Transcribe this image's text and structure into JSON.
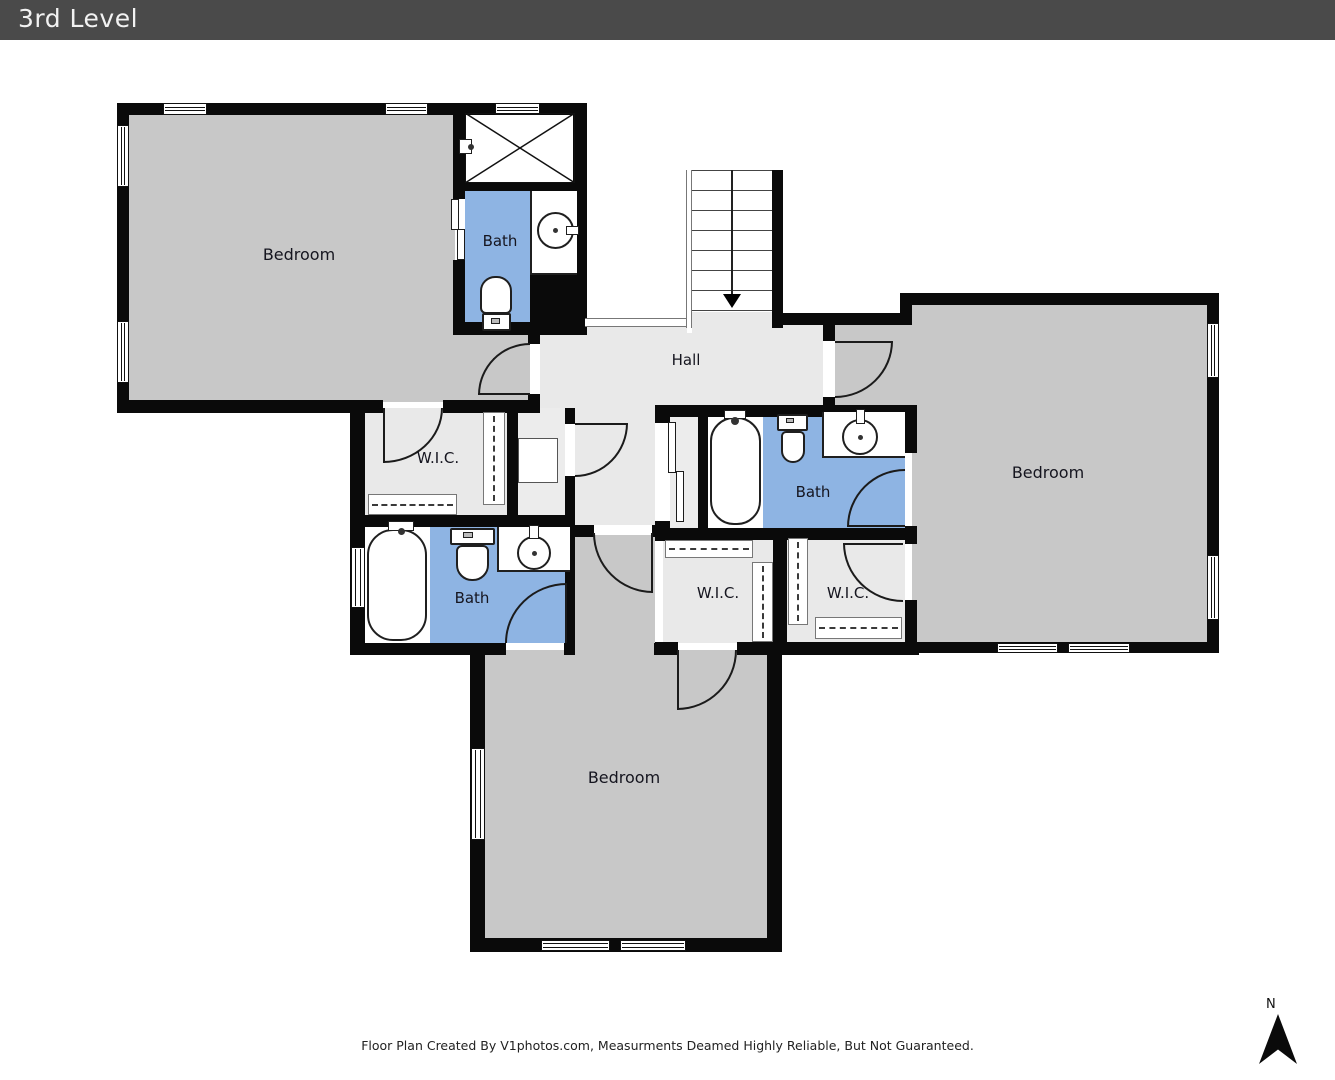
{
  "header": {
    "title": "3rd Level"
  },
  "rooms": {
    "bedroom_top_left": "Bedroom",
    "bath_top": "Bath",
    "hall": "Hall",
    "wic_left": "W.I.C.",
    "bath_left": "Bath",
    "bath_right": "Bath",
    "wic_center": "W.I.C.",
    "wic_right": "W.I.C.",
    "bedroom_bottom": "Bedroom",
    "bedroom_right": "Bedroom"
  },
  "compass": {
    "label": "N"
  },
  "footer": {
    "text": "Floor Plan Created By V1photos.com, Measurments Deamed Highly Reliable, But Not Guaranteed."
  },
  "colors": {
    "header_bg": "#4a4a4a",
    "header_text": "#f2f2f2",
    "wall": "#0a0a0a",
    "bedroom_floor": "#c8c8c8",
    "hall_floor": "#e9e9e9",
    "bath_floor": "#8eb4e3",
    "closet_floor": "#ececec"
  }
}
